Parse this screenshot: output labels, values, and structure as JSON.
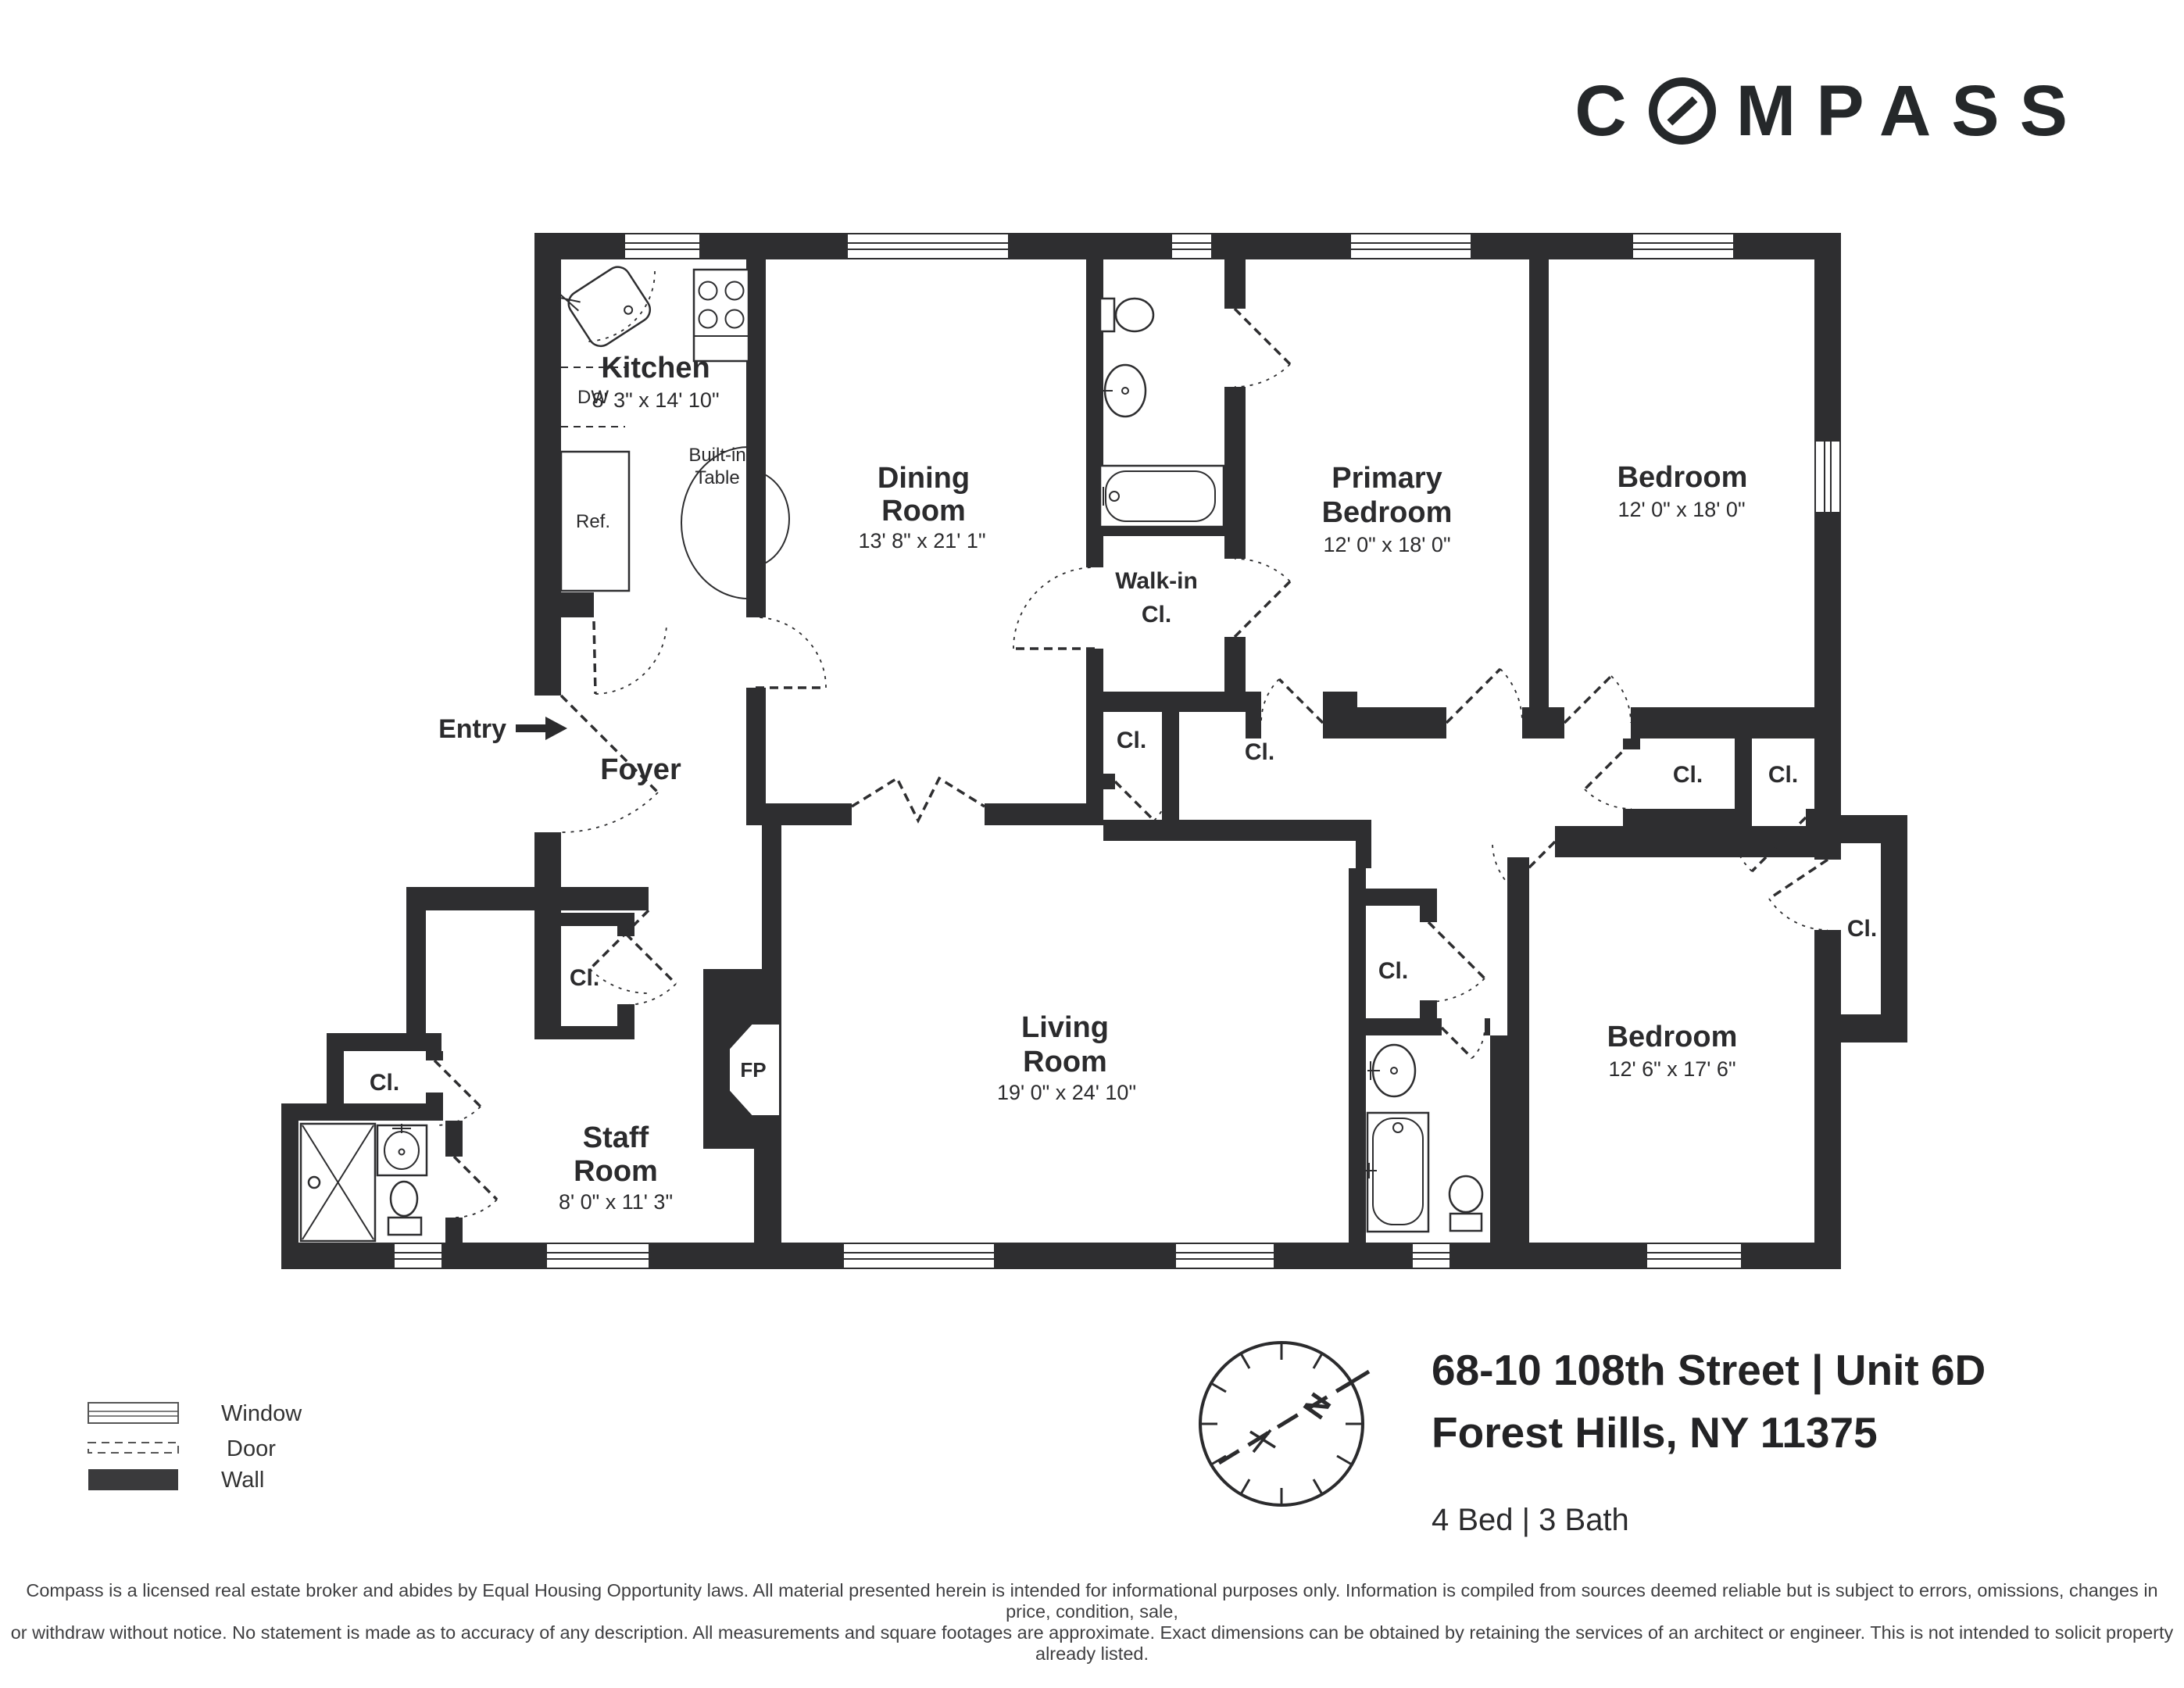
{
  "logo": {
    "left": "C",
    "right": "MPASS"
  },
  "plan": {
    "rooms": {
      "kitchen": {
        "name": "Kitchen",
        "dims": "8' 3\" x 14' 10\""
      },
      "dining": {
        "line1": "Dining",
        "line2": "Room",
        "dims": "13' 8\" x 21' 1\""
      },
      "primary_bedroom": {
        "line1": "Primary",
        "line2": "Bedroom",
        "dims": "12' 0\" x 18' 0\""
      },
      "bedroom2": {
        "name": "Bedroom",
        "dims": "12' 0\" x 18' 0\""
      },
      "bedroom3": {
        "name": "Bedroom",
        "dims": "12' 6\" x 17' 6\""
      },
      "living": {
        "line1": "Living",
        "line2": "Room",
        "dims": "19' 0\" x 24' 10\""
      },
      "staff": {
        "line1": "Staff",
        "line2": "Room",
        "dims": "8' 0\" x 11' 3\""
      },
      "walkin": {
        "line1": "Walk-in",
        "line2": "Cl."
      },
      "foyer": "Foyer"
    },
    "labels": {
      "entry": "Entry",
      "closet": "Cl.",
      "fireplace": "FP",
      "dishwasher": "DW",
      "refrigerator": "Ref.",
      "builtin1": "Built-in",
      "builtin2": "Table"
    }
  },
  "legend": {
    "window": "Window",
    "door": "Door",
    "wall": "Wall"
  },
  "info": {
    "address_line1": "68-10 108th Street | Unit 6D",
    "address_line2": "Forest Hills, NY 11375",
    "beds_baths": "4 Bed | 3 Bath",
    "compass_n": "N"
  },
  "disclaimer": {
    "line1": "Compass is a licensed real estate broker and abides by Equal Housing Opportunity laws. All material presented herein is intended for informational purposes only. Information is compiled from sources deemed reliable but is subject to errors, omissions, changes in price, condition, sale,",
    "line2": "or withdraw without notice. No statement is made as to accuracy of any description. All measurements and square footages are approximate. Exact dimensions can be obtained by retaining the services of an architect or engineer. This is not intended to solicit property already listed."
  },
  "colors": {
    "wall": "#2e2e30",
    "text": "#2b2b2d",
    "logo": "#25282a"
  }
}
